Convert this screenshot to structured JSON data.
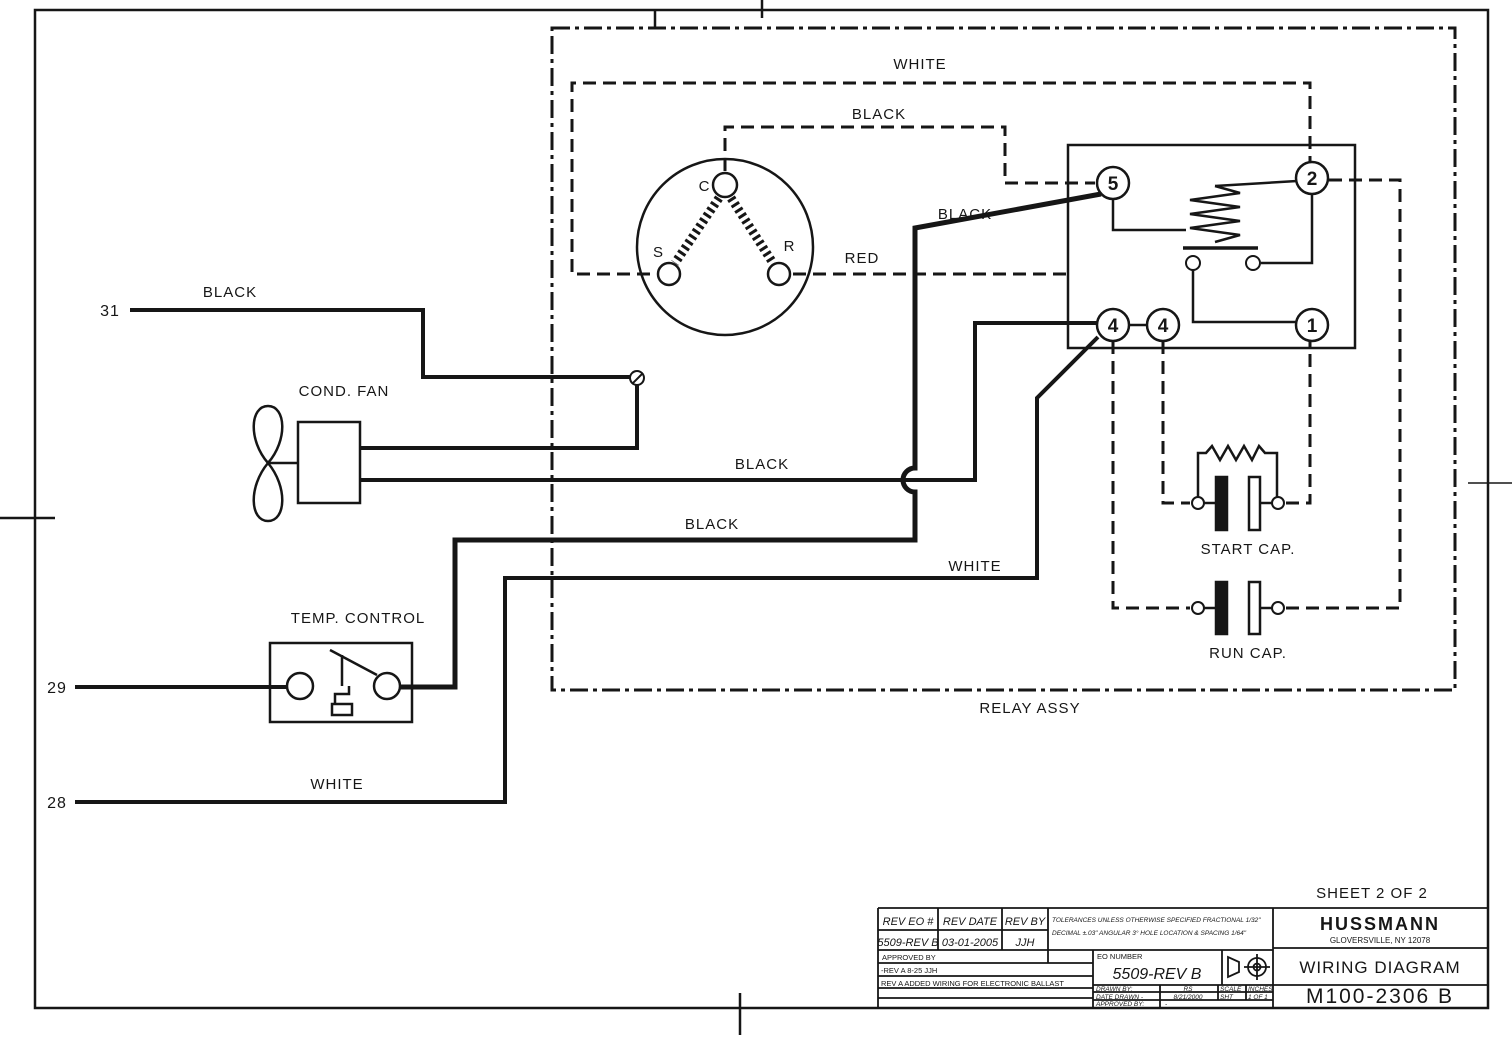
{
  "colors": {
    "ink": "#161616",
    "paper": "#ffffff"
  },
  "sheet": {
    "note": "SHEET 2 OF 2"
  },
  "schematic": {
    "connectors": {
      "w31": "31",
      "w29": "29",
      "w28": "28"
    },
    "wires": {
      "black_31": "BLACK",
      "black_fan": "BLACK",
      "black_ctrl": "BLACK",
      "black_relay": "BLACK",
      "black_motor": "BLACK",
      "white_motor": "WHITE",
      "white_ctrl": "WHITE",
      "white_28": "WHITE",
      "red_motor": "RED"
    },
    "components": {
      "cond_fan": "COND. FAN",
      "temp_control": "TEMP. CONTROL",
      "start_cap": "START CAP.",
      "run_cap": "RUN CAP.",
      "relay_assy": "RELAY ASSY"
    },
    "motor": {
      "c": "C",
      "s": "S",
      "r": "R"
    },
    "relay": {
      "t5": "5",
      "t2": "2",
      "t4a": "4",
      "t4b": "4",
      "t1": "1"
    }
  },
  "title_block": {
    "rev_table": {
      "headers": [
        "REV EO #",
        "REV DATE",
        "REV BY"
      ],
      "values": [
        "5509-REV B",
        "03-01-2005",
        "JJH"
      ]
    },
    "tolerances": {
      "line1": "TOLERANCES UNLESS OTHERWISE SPECIFIED FRACTIONAL 1/32\"",
      "line2": "DECIMAL ±.03\" ANGULAR 3° HOLE LOCATION & SPACING 1/64\""
    },
    "approved_row": "APPROVED BY",
    "rev_notes": [
      "-REV A 8-25 JJH",
      "REV A ADDED WIRING FOR ELECTRONIC BALLAST"
    ],
    "eo_number": {
      "label": "EO NUMBER",
      "value": "5509-REV B"
    },
    "drawn_by": {
      "label": "DRAWN BY:",
      "value": "RS"
    },
    "scale": {
      "label": "SCALE",
      "value": "INCHES"
    },
    "date_drawn": {
      "label": "DATE DRAWN -",
      "value": "8/21/2000"
    },
    "sheet_cell": {
      "label": "SHT",
      "value": "1 OF 1"
    },
    "approved_by": {
      "label": "APPROVED BY:",
      "value": "-"
    },
    "company": {
      "name": "HUSSMANN",
      "location": "GLOVERSVILLE, NY 12078"
    },
    "doc_type": "WIRING DIAGRAM",
    "doc_number": "M100-2306 B"
  }
}
